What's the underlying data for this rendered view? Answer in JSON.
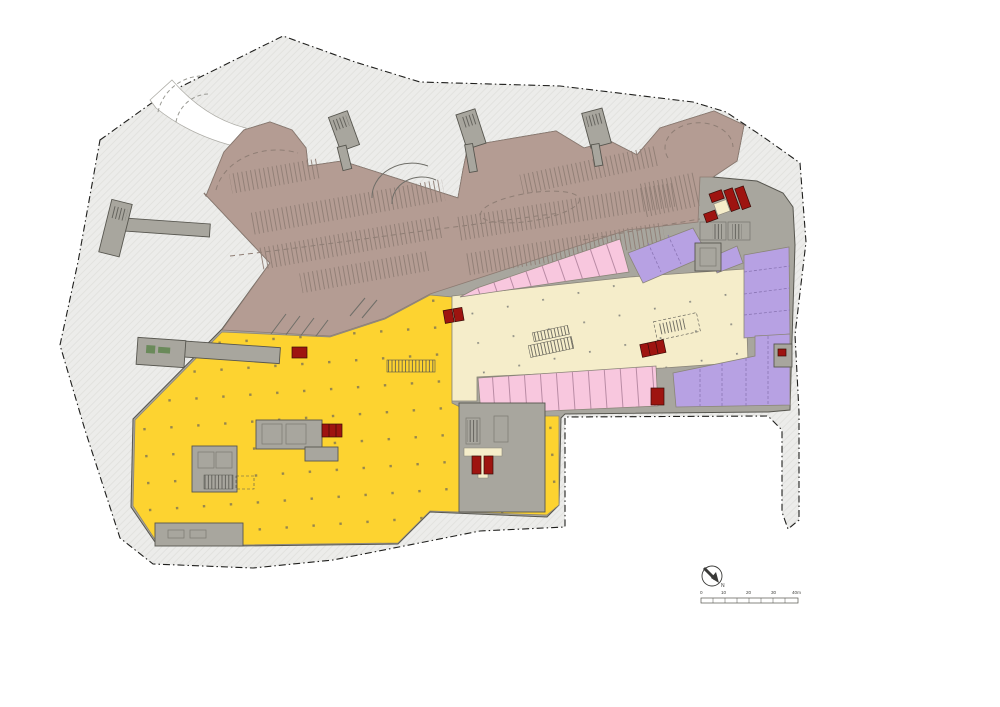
{
  "annotation": {
    "north_label": "N",
    "scale_labels": [
      "0",
      "10",
      "20",
      "30",
      "40m"
    ]
  },
  "colors": {
    "page": "#FFFFFF",
    "site": "#ECECEA",
    "site_hatch_line": "#E2E2DF",
    "boundary": "#1F1F1D",
    "building": "#A8A69E",
    "building_line": "#57564F",
    "room_line": "#7B7A73",
    "parking": "#B49C93",
    "parking_line": "#8D7B72",
    "lane_dash": "#8F7E75",
    "mall_cream": "#F5EDCA",
    "retail_pink": "#F8C7DE",
    "pink_line": "#B2849E",
    "retail_purple": "#B7A1E3",
    "purple_line": "#8A75B4",
    "anchor_yellow": "#FDD330",
    "column_dot": "#97864C",
    "core_red": "#9E1410",
    "green": "#6A8A5A",
    "road_white": "#FFFFFF",
    "annotation_ink": "#3A3A38"
  }
}
